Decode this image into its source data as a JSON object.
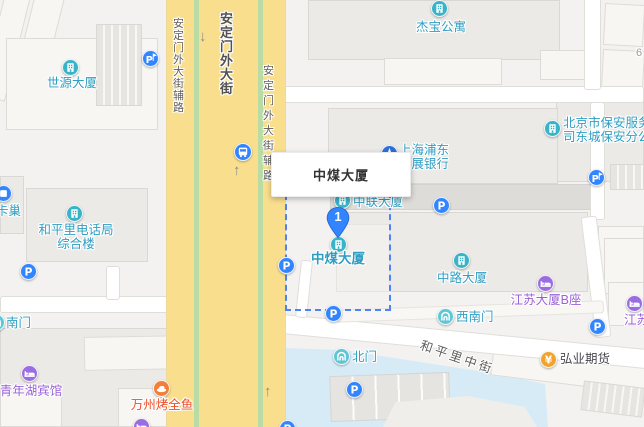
{
  "map": {
    "popup": {
      "title": "中煤大厦"
    },
    "marker": {
      "number": "1",
      "name": "中煤大厦"
    },
    "colors": {
      "poi_teal": "#38b3c8",
      "poi_gate": "#5ec7d6",
      "poi_blue": "#3385ff",
      "poi_bank_blue": "#2f6fd6",
      "poi_purple": "#9a6ee0",
      "poi_orange": "#f57d3a",
      "poi_yellow": "#f0a32f",
      "label_teal": "#2f9ec2",
      "label_purple": "#9a62d8",
      "label_orange": "#e8502a",
      "road_yellow": "#f9df8d",
      "median_green": "#b9dba4",
      "water_blue": "#d7ebf7",
      "dashed_blue": "#4f83f5"
    },
    "road_labels": [
      {
        "name": "road-label-andingmenwai-fulu-west",
        "text": "安定门外大街辅路",
        "x": 171,
        "y": 18,
        "mode": "v",
        "fs": 11,
        "lh": 12
      },
      {
        "name": "road-label-andingmenwai-dajie",
        "text": "安定门外大街",
        "x": 218,
        "y": 12,
        "mode": "v",
        "fs": 13,
        "lh": 14,
        "bold": true
      },
      {
        "name": "road-label-andingmenwai-fulu-east",
        "text": "安定门外大街辅路",
        "x": 261,
        "y": 64,
        "mode": "v",
        "fs": 11,
        "lh": 15
      },
      {
        "name": "road-label-hepingli-zhongjie",
        "text": "和平里中街",
        "x": 421,
        "y": 334,
        "mode": "r",
        "angle": 19,
        "fs": 12.5,
        "sp": 3
      },
      {
        "name": "road-ref-6",
        "text": "6",
        "x": 636,
        "y": 47,
        "mode": "h",
        "fs": 11
      }
    ],
    "arrows": [
      {
        "glyph": "↓",
        "x": 199,
        "y": 28
      },
      {
        "glyph": "↑",
        "x": 233,
        "y": 162
      },
      {
        "glyph": "↑",
        "x": 264,
        "y": 383
      }
    ],
    "pois": [
      {
        "n": "shiyuan-dasha",
        "t": "building",
        "x": 70,
        "y": 67,
        "c": "teal",
        "l": "世源大厦",
        "lx": 72,
        "ly": 76,
        "la": "c",
        "lc": "teal"
      },
      {
        "n": "jiebao-gongyu",
        "t": "building",
        "x": 439,
        "y": 8,
        "c": "teal",
        "l": "杰宝公寓",
        "lx": 441,
        "ly": 20,
        "la": "c",
        "lc": "teal"
      },
      {
        "n": "beijing-baoan-fuwu",
        "t": "building",
        "x": 552,
        "y": 128,
        "c": "teal",
        "lines": [
          "北京市保安服务",
          "司东城保安分公"
        ],
        "lx": 563,
        "ly": 116,
        "la": "l",
        "lc": "teal"
      },
      {
        "n": "shanghai-pudong-bank",
        "t": "bank",
        "x": 389,
        "y": 153,
        "c": "bankblue",
        "lines": [
          "上海浦东",
          "发展银行"
        ],
        "lx": 399,
        "ly": 143,
        "la": "l",
        "lc": "teal"
      },
      {
        "n": "zhonglian-dasha",
        "t": "building",
        "x": 342,
        "y": 200,
        "c": "teal",
        "l": "中联大厦",
        "lx": 353,
        "ly": 195,
        "la": "l",
        "lc": "teal"
      },
      {
        "n": "zhongmei-dasha",
        "t": "building",
        "x": 338,
        "y": 244,
        "c": "teal",
        "l": "中煤大厦",
        "lx": 338,
        "ly": 252,
        "la": "c",
        "lc": "teal",
        "ls": 13.5,
        "bold": true
      },
      {
        "n": "zhonglu-dasha",
        "t": "building",
        "x": 461,
        "y": 260,
        "c": "teal",
        "l": "中路大厦",
        "lx": 462,
        "ly": 271,
        "la": "c",
        "lc": "teal"
      },
      {
        "n": "kachao",
        "t": "box",
        "x": 3,
        "y": 193,
        "c": "blue",
        "l": "卡巢",
        "lx": -4,
        "ly": 204,
        "la": "l",
        "lc": "teal"
      },
      {
        "n": "hepingli-dianhuaju",
        "t": "building",
        "x": 74,
        "y": 213,
        "c": "teal",
        "lines": [
          "和平里电话局",
          "综合楼"
        ],
        "lx": 76,
        "ly": 223,
        "la": "c",
        "lc": "teal"
      },
      {
        "n": "qingnianhu-binguan",
        "t": "hotel",
        "x": 29,
        "y": 373,
        "c": "purple",
        "l": "青年湖宾馆",
        "lx": 31,
        "ly": 384,
        "la": "c",
        "lc": "purple"
      },
      {
        "n": "jiangsu-dasha-b-zuo",
        "t": "hotel",
        "x": 545,
        "y": 283,
        "c": "purple",
        "l": "江苏大厦B座",
        "lx": 546,
        "ly": 293,
        "la": "c",
        "lc": "purple"
      },
      {
        "n": "jiangsu-partial",
        "t": "hotel",
        "x": 634,
        "y": 303,
        "c": "purple",
        "l": "江苏",
        "lx": 624,
        "ly": 313,
        "la": "l",
        "lc": "purple"
      },
      {
        "n": "wanzhou-kaoquanyu",
        "t": "food",
        "x": 161,
        "y": 388,
        "c": "orange",
        "l": "万州烤全鱼",
        "lx": 162,
        "ly": 398,
        "la": "c",
        "lc": "orange"
      },
      {
        "n": "hongye-qihuo",
        "t": "yen",
        "x": 548,
        "y": 359,
        "c": "yellow",
        "l": "弘业期货",
        "lx": 560,
        "ly": 352,
        "la": "l",
        "lc": "dark"
      },
      {
        "n": "xinanmen-gate",
        "t": "gate",
        "x": 445,
        "y": 316,
        "c": "gate",
        "l": "西南门",
        "lx": 456,
        "ly": 310,
        "la": "l",
        "lc": "teal"
      },
      {
        "n": "beimen-gate",
        "t": "gate",
        "x": 341,
        "y": 356,
        "c": "gate",
        "l": "北门",
        "lx": 352,
        "ly": 350,
        "la": "l",
        "lc": "teal"
      },
      {
        "n": "nanmen-gate",
        "t": "gate",
        "x": -4,
        "y": 322,
        "c": "gate",
        "l": "南门",
        "lx": 6,
        "ly": 316,
        "la": "l",
        "lc": "teal"
      },
      {
        "n": "parking-entrance",
        "t": "parking-entrance",
        "x": 150,
        "y": 58,
        "c": "blue"
      },
      {
        "n": "parking-entrance",
        "t": "parking-entrance",
        "x": 596,
        "y": 177,
        "c": "blue"
      },
      {
        "n": "parking",
        "t": "parking",
        "x": 28,
        "y": 271,
        "c": "blue"
      },
      {
        "n": "parking",
        "t": "parking",
        "x": 286,
        "y": 265,
        "c": "blue"
      },
      {
        "n": "parking",
        "t": "parking",
        "x": 333,
        "y": 313,
        "c": "blue"
      },
      {
        "n": "parking",
        "t": "parking",
        "x": 354,
        "y": 389,
        "c": "blue"
      },
      {
        "n": "parking",
        "t": "parking",
        "x": 597,
        "y": 326,
        "c": "blue"
      },
      {
        "n": "parking",
        "t": "parking",
        "x": 441,
        "y": 205,
        "c": "blue"
      },
      {
        "n": "bus-stop",
        "t": "bus",
        "x": 243,
        "y": 152,
        "c": "blue"
      },
      {
        "n": "hotel-partial-bottom",
        "t": "hotel",
        "x": 141,
        "y": 426,
        "c": "purple"
      },
      {
        "n": "parking-partial-bottom",
        "t": "parking",
        "x": 287,
        "y": 428,
        "c": "blue"
      }
    ]
  }
}
